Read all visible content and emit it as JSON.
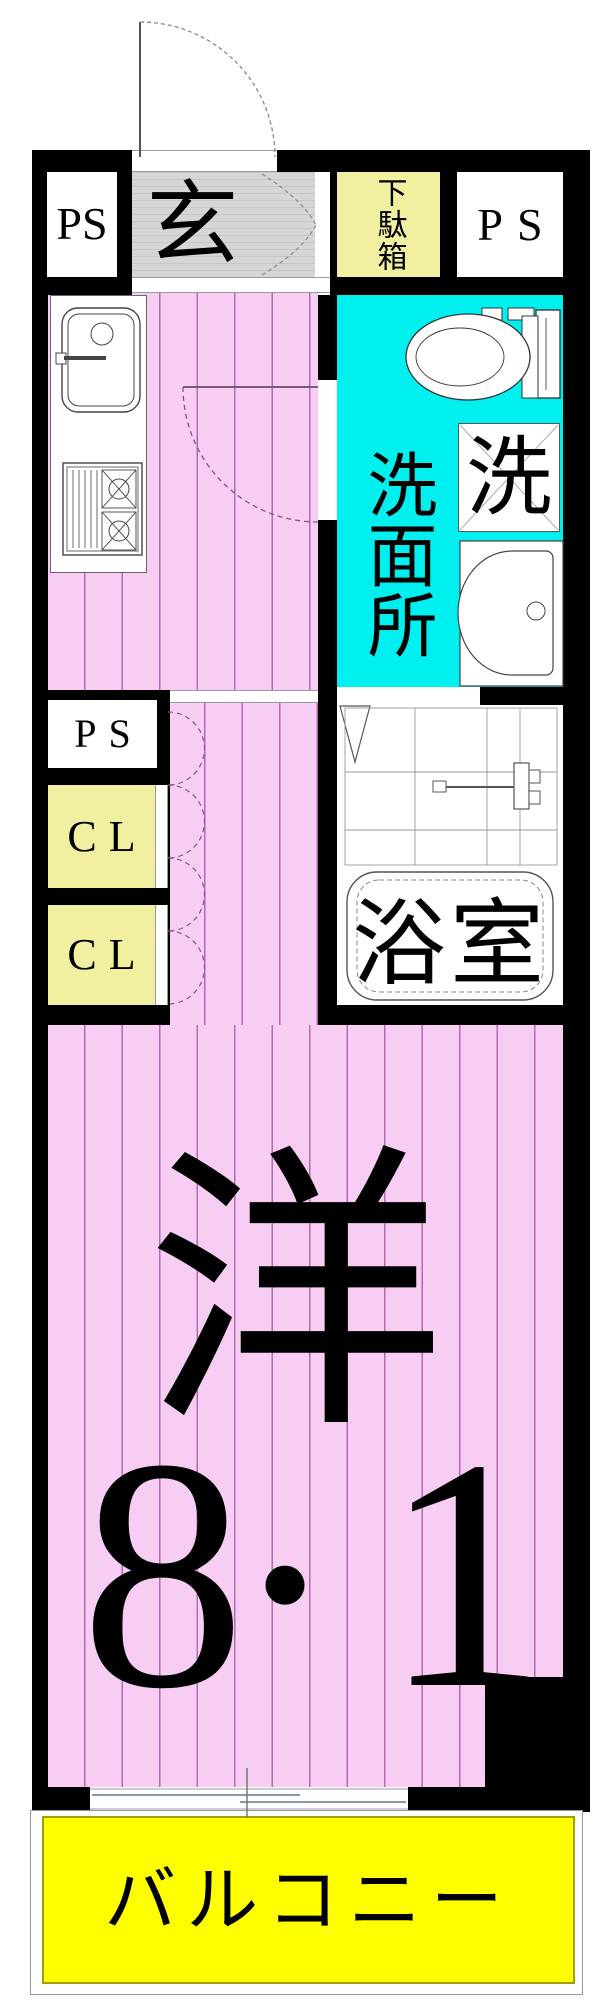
{
  "floorplan": {
    "labels": {
      "pipe_space": "PS",
      "entrance": "玄",
      "shoe_cabinet": "下駄箱",
      "washroom": "洗面所",
      "laundry": "洗",
      "bathroom": "浴室",
      "closet": "CL",
      "western_room": "洋",
      "area_parts": [
        "8",
        ".",
        "1"
      ],
      "balcony": "バルコニー"
    },
    "colors": {
      "wall": "#000000",
      "floor_pink": "#F7CDF3",
      "floor_stripe": "#B06CB0",
      "washroom_cyan": "#00EFEF",
      "storage_yellow": "#F1EFA0",
      "balcony_yellow": "#FFFF00",
      "entrance_gray": "#D6D6D6"
    }
  }
}
